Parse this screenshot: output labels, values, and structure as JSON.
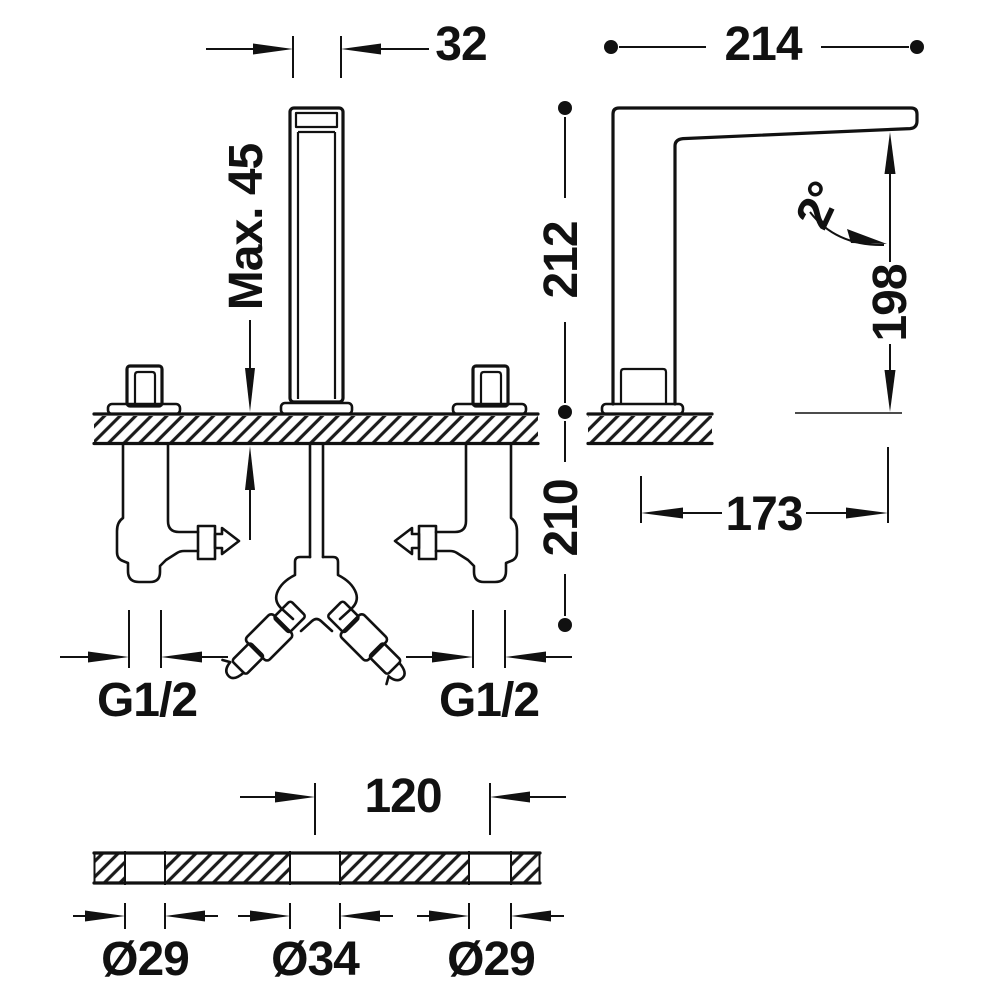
{
  "drawing": {
    "kind": "faucet installation dimensions",
    "colors": {
      "line": "#111111",
      "background": "#ffffff"
    },
    "views": {
      "front": {
        "dim_spout_width": "32",
        "dim_max_deck_thickness": "Max. 45",
        "dim_thread_left": "G1/2",
        "dim_thread_right": "G1/2"
      },
      "side": {
        "dim_overall_depth": "214",
        "dim_height_above_deck": "212",
        "dim_depth_below_deck": "210",
        "dim_outlet_height": "198",
        "dim_spout_reach": "173",
        "dim_spout_angle": "2°"
      },
      "plan": {
        "dim_hole_spacing": "120",
        "dim_hole_left": "Ø29",
        "dim_hole_center": "Ø34",
        "dim_hole_right": "Ø29"
      }
    }
  }
}
